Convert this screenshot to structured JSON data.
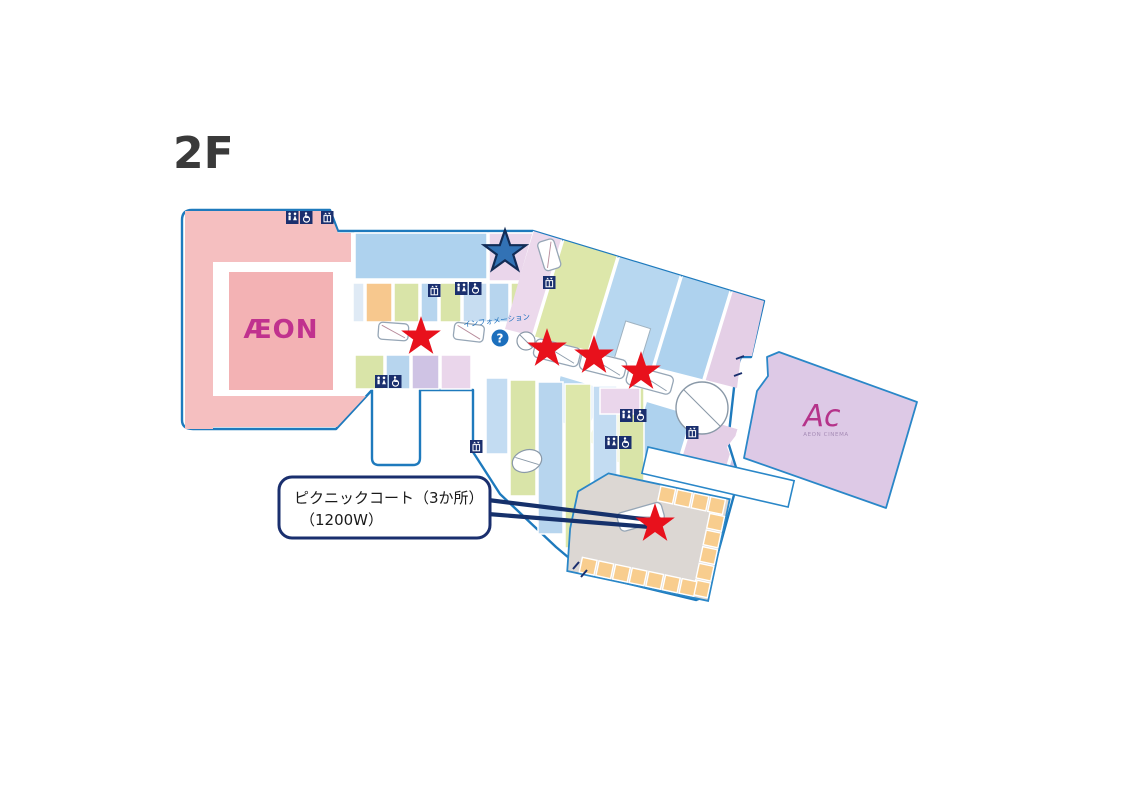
{
  "title": "2F",
  "map": {
    "labels": {
      "aeon": "ÆON",
      "cinema_logo": "Ac",
      "cinema_name": "AEON CINEMA",
      "information": "インフォメーション",
      "information_symbol": "?"
    },
    "callout": {
      "line1": "ピクニックコート（3か所）",
      "line2": "（1200W）"
    },
    "stars": {
      "blue": [
        {
          "x": 505,
          "y": 252
        }
      ],
      "red": [
        {
          "x": 421,
          "y": 337
        },
        {
          "x": 547,
          "y": 349
        },
        {
          "x": 594,
          "y": 356
        },
        {
          "x": 641,
          "y": 372
        },
        {
          "x": 655,
          "y": 524
        }
      ]
    },
    "colors": {
      "outline": "#1e7abd",
      "navy": "#1a2f6e",
      "star_red": "#e8111c",
      "star_blue": "#3272b5",
      "star_blue_stroke": "#122c56",
      "aeon_pink": "#f5bfc0",
      "aeon_pink_inner": "#f3b2b4",
      "aeon_logo": "#c0328e",
      "info_blue": "#1c6fbd",
      "cinema_fill": "#ddc9e6",
      "cinema_logo_color": "#b5338a",
      "food_court_gray": "#dcd7d3",
      "food_court_orange": "#f8cd8e"
    }
  }
}
